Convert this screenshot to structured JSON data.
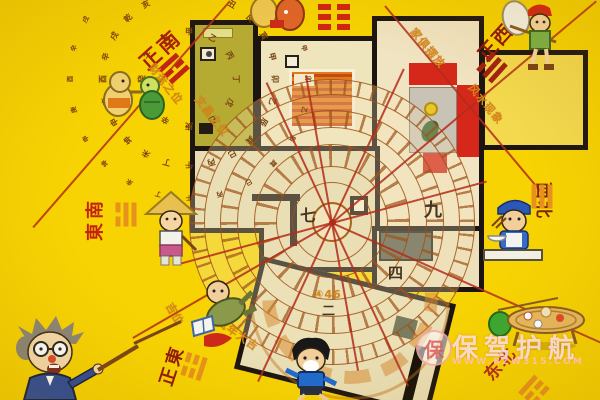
{
  "palette": {
    "bg": "#f7d303",
    "wall": "#1c1410",
    "red": "#d5281a",
    "annotation": "#d8881a"
  },
  "watermark": {
    "logo_char": "保",
    "brand": "保驾护航",
    "url": "WWW.BZW315.COM"
  },
  "directions": [
    {
      "id": "zhengnan",
      "label": "正南",
      "trigram": [
        1,
        0,
        1
      ]
    },
    {
      "id": "zhengxi",
      "label": "正西",
      "trigram": [
        0,
        1,
        1
      ]
    },
    {
      "id": "dongnan",
      "label": "東南",
      "trigram": [
        1,
        1,
        0
      ]
    },
    {
      "id": "zhengdong",
      "label": "正東",
      "trigram": [
        0,
        0,
        1
      ]
    },
    {
      "id": "xibei",
      "label": "西北",
      "trigram": [
        1,
        1,
        1
      ]
    },
    {
      "id": "dongbei",
      "label": "东北",
      "trigram": [
        1,
        0,
        0
      ]
    }
  ],
  "hexagram_top": {
    "pattern": [
      [
        1,
        1
      ],
      [
        1,
        1
      ],
      [
        1,
        1
      ]
    ]
  },
  "compass": {
    "ring_outer": "子癸丑艮寅甲卯乙辰巽巳丙午丁未坤申庚酉辛戌乾亥壬",
    "ring_inner": "甲乙丙丁戊己庚辛壬癸子丑",
    "numerals": [
      "九",
      "七",
      "四",
      "二"
    ],
    "rays": [
      {
        "x": 332,
        "y": 222,
        "a": -40,
        "l": 345
      },
      {
        "x": 332,
        "y": 222,
        "a": 24,
        "l": 298
      },
      {
        "x": 332,
        "y": 222,
        "a": -15,
        "l": 160
      },
      {
        "x": 332,
        "y": 222,
        "a": 165,
        "l": 160
      },
      {
        "x": 332,
        "y": 222,
        "a": 65,
        "l": 180
      },
      {
        "x": 332,
        "y": 222,
        "a": 245,
        "l": 155
      },
      {
        "x": 332,
        "y": 222,
        "a": -65,
        "l": 170
      },
      {
        "x": 332,
        "y": 222,
        "a": 115,
        "l": 175
      },
      {
        "x": 332,
        "y": 222,
        "a": -100,
        "l": 150
      },
      {
        "x": 332,
        "y": 222,
        "a": 80,
        "l": 150
      },
      {
        "x": 332,
        "y": 222,
        "a": 150,
        "l": 230
      },
      {
        "x": 230,
        "y": 0,
        "a": 131,
        "l": 300
      },
      {
        "x": 385,
        "y": 5,
        "a": 50,
        "l": 250
      }
    ]
  },
  "annotations": [
    {
      "text": "财运之位",
      "x": 142,
      "y": 76,
      "r": 52
    },
    {
      "text": "文昌之位",
      "x": 188,
      "y": 108,
      "r": 52
    },
    {
      "text": "家俱摆放",
      "x": 404,
      "y": 40,
      "r": 50
    },
    {
      "text": "风水现象",
      "x": 462,
      "y": 96,
      "r": 50
    },
    {
      "text": "流年大吉",
      "x": 214,
      "y": 326,
      "r": 35
    },
    {
      "text": "吉位",
      "x": 163,
      "y": 306,
      "r": 60
    },
    {
      "text": "④46",
      "x": 314,
      "y": 288,
      "r": 0
    }
  ],
  "characters": [
    "professor-pointing",
    "running-boy",
    "cook",
    "boy-with-net",
    "farmer-with-hat",
    "tumbling-reader",
    "cartoon-duo-left",
    "cartoon-duo-top",
    "banquet-table"
  ]
}
